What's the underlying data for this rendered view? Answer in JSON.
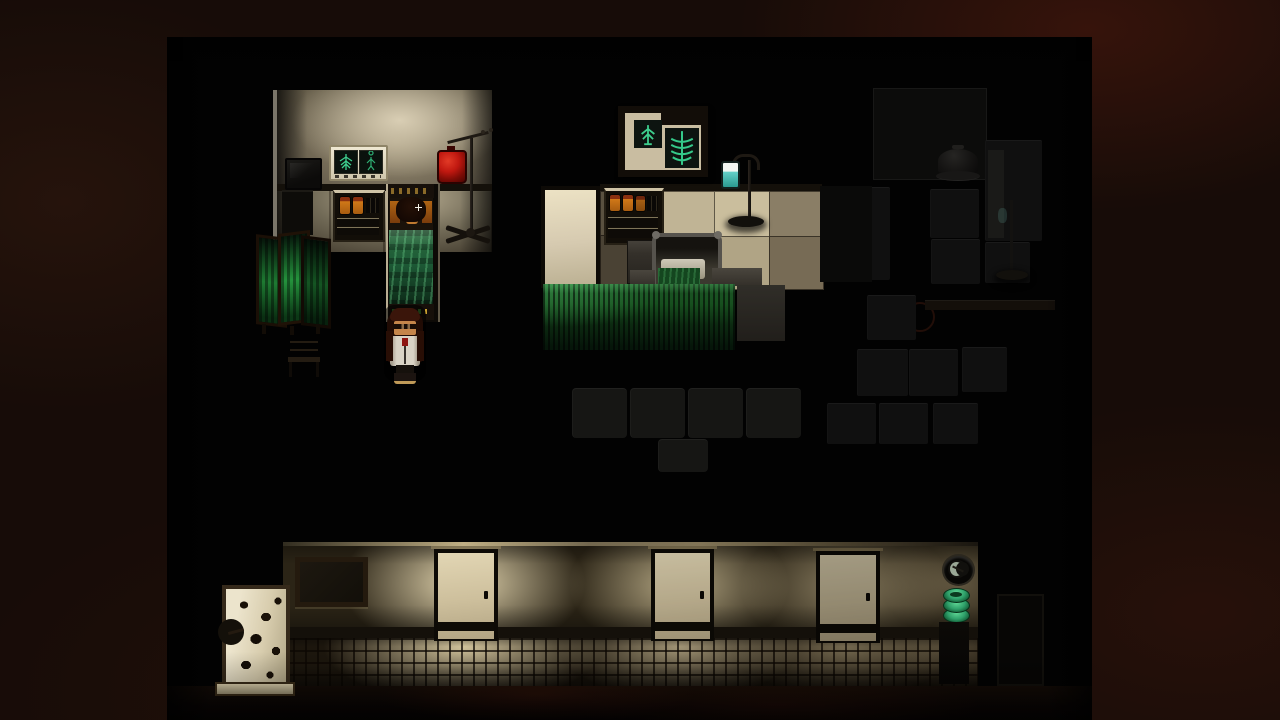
{
  "scene": {
    "label": "Dark hospital ward scene in a pixel-art horror game"
  },
  "palette": {
    "bg_outer": "#170c08",
    "viewport_bg": "#020202",
    "wall_lit": "#d9ceb4",
    "rail_dark": "#14100a",
    "floor_lit": "#d2c7ab",
    "door_cream": "#e2d6b4",
    "door_frame": "#0d0a06",
    "screen_green": "#1e7a32",
    "skirt_green": "#17501f",
    "bed_green": "#1d5a36",
    "blood_red": "#c01810",
    "xray_green": "#3ecf8e",
    "jar_orange": "#d07818",
    "teal": "#63cfc6",
    "skin": "#c5854a",
    "hair": "#3a150a",
    "coat": "#d9d3c5",
    "clock_moon": "#9aa896",
    "stack_green": "#2fa06a"
  },
  "rooms": {
    "exam_room": {
      "label": "examination room",
      "objects": {
        "monitor": {
          "label": "dark monitor on stand"
        },
        "xray_lightbox": {
          "label": "x-ray light box with two films"
        },
        "medicine_cabinet": {
          "label": "medicine cabinet with orange jars"
        },
        "occupied_bed": {
          "label": "hospital bed with sleeping patient under green blanket"
        },
        "iv_stand_blood": {
          "label": "IV stand with red blood bag"
        },
        "folding_screen": {
          "label": "green folding privacy screen"
        },
        "chair": {
          "label": "dark chair"
        },
        "player": {
          "label": "player character with glasses and white coat"
        }
      }
    },
    "ward_room": {
      "label": "ward room",
      "objects": {
        "xray_frame": {
          "label": "framed x-ray pictures"
        },
        "white_door": {
          "label": "bright ward door"
        },
        "medicine_cabinet": {
          "label": "medicine cabinet with orange jars"
        },
        "locker": {
          "label": "bedside locker"
        },
        "iv_stand_teal": {
          "label": "IV stand with teal bottle"
        },
        "bed_frame": {
          "label": "metal bed headboard"
        },
        "curtain": {
          "label": "green bed curtain"
        }
      }
    },
    "dark_ward": {
      "label": "unlit ward",
      "objects": {
        "cloche": {
          "label": "covered dish"
        },
        "iv_silhouette": {
          "label": "IV stand silhouette"
        },
        "cabinets": {
          "label": "dark cabinets and beds"
        }
      }
    },
    "corridor": {
      "label": "hospital corridor",
      "doors": [
        {
          "label": "corridor door 1"
        },
        {
          "label": "corridor door 2"
        },
        {
          "label": "corridor door 3"
        },
        {
          "label": "dark corridor door"
        }
      ],
      "objects": {
        "stained_panel": {
          "label": "pale panel with dark stains"
        },
        "notice_board": {
          "label": "dark notice board"
        },
        "clock": {
          "label": "wall clock"
        },
        "green_stack": {
          "label": "stack of green basins"
        }
      }
    }
  }
}
